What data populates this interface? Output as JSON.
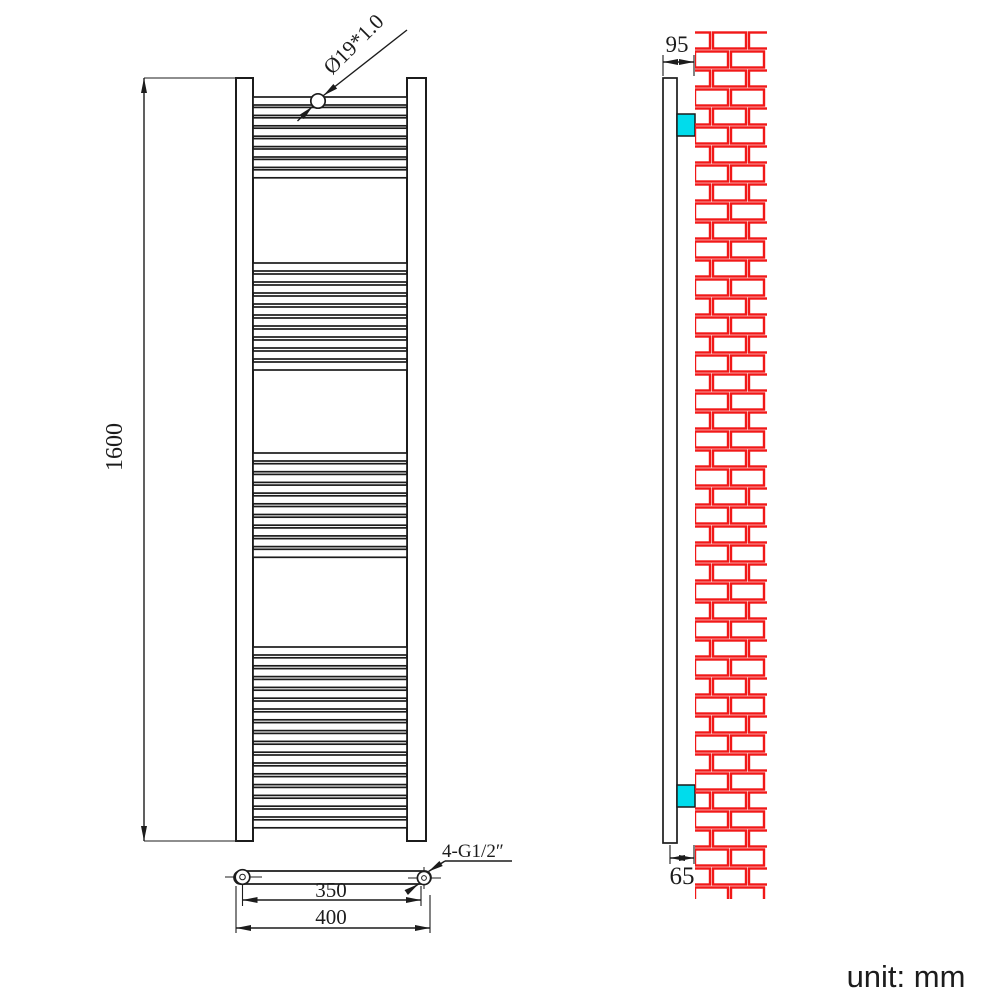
{
  "unit_label": "unit: mm",
  "front_view": {
    "height_label": "1600",
    "tube_spec_label": "Ø19*1.0",
    "pitch_label": "350",
    "width_label": "400",
    "connection_label": "4-G1/2″",
    "tube_area": {
      "x": 253,
      "width": 154,
      "tube_height": 8
    },
    "tube_groups": [
      {
        "y": 97,
        "count": 8,
        "pitch": 10.4
      },
      {
        "y": 263,
        "count": 10,
        "pitch": 11.0
      },
      {
        "y": 453,
        "count": 10,
        "pitch": 10.7
      },
      {
        "y": 647,
        "count": 17,
        "pitch": 10.8
      }
    ]
  },
  "side_view": {
    "depth_label": "95",
    "wall_offset_label": "65",
    "wall": {
      "x": 695,
      "y": 31,
      "width": 72,
      "height": 868,
      "row_height": 19,
      "brick_width": 33,
      "brick_height": 16,
      "gap": 3,
      "offset": 18
    }
  },
  "colors": {
    "line": "#1c1c1c",
    "brick": "#f11818",
    "bracket": "#00dcec"
  }
}
